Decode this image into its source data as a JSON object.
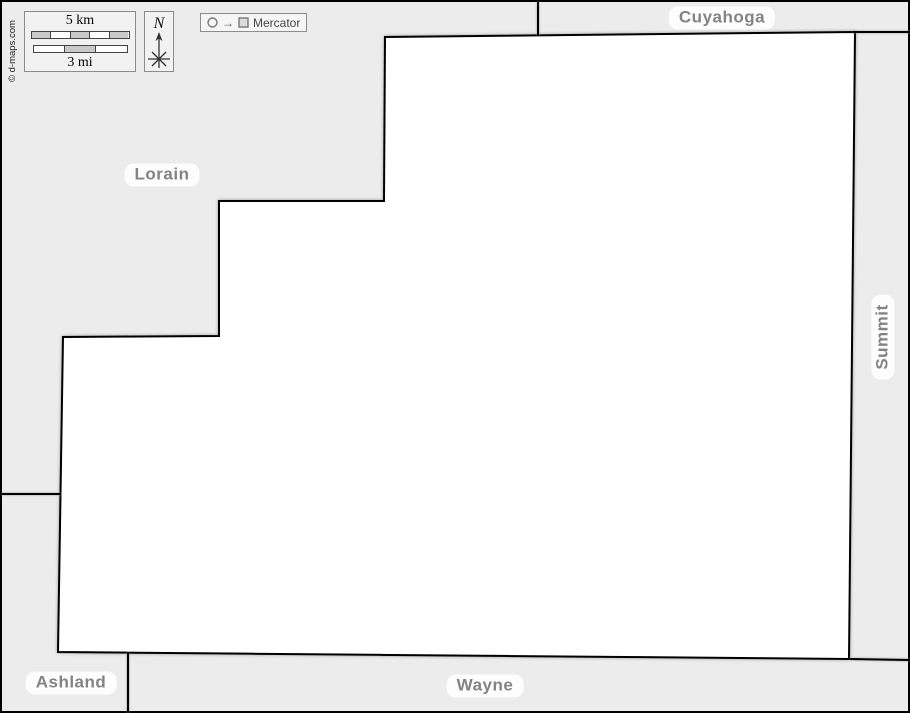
{
  "canvas": {
    "background": "#ececec",
    "frame_color": "#000000",
    "county_fill": "#ffffff",
    "border_color": "#000000",
    "label_color": "#838383"
  },
  "copyright": "© d-maps.com",
  "scale": {
    "km_label": "5 km",
    "mi_label": "3 mi"
  },
  "compass": {
    "north_label": "N"
  },
  "projection": {
    "arrow": "→",
    "label": "Mercator"
  },
  "neighbors": {
    "top": {
      "name": "Cuyahoga"
    },
    "left": {
      "name": "Lorain"
    },
    "right": {
      "name": "Summit"
    },
    "bottom_left": {
      "name": "Ashland"
    },
    "bottom": {
      "name": "Wayne"
    }
  },
  "map": {
    "county_points": "385,37 855,32 849,659 58,652 63,337 219,336 219,201 384,201",
    "borders": {
      "cuyahoga_lorain": "M538,2 L538,36",
      "cuyahoga_summit": "M853,32 L910,32",
      "lorain_ashland": "M2,494 L61,494",
      "ashland_wayne": "M128,653 L128,712",
      "summit_wayne": "M850,659 L910,660"
    }
  }
}
